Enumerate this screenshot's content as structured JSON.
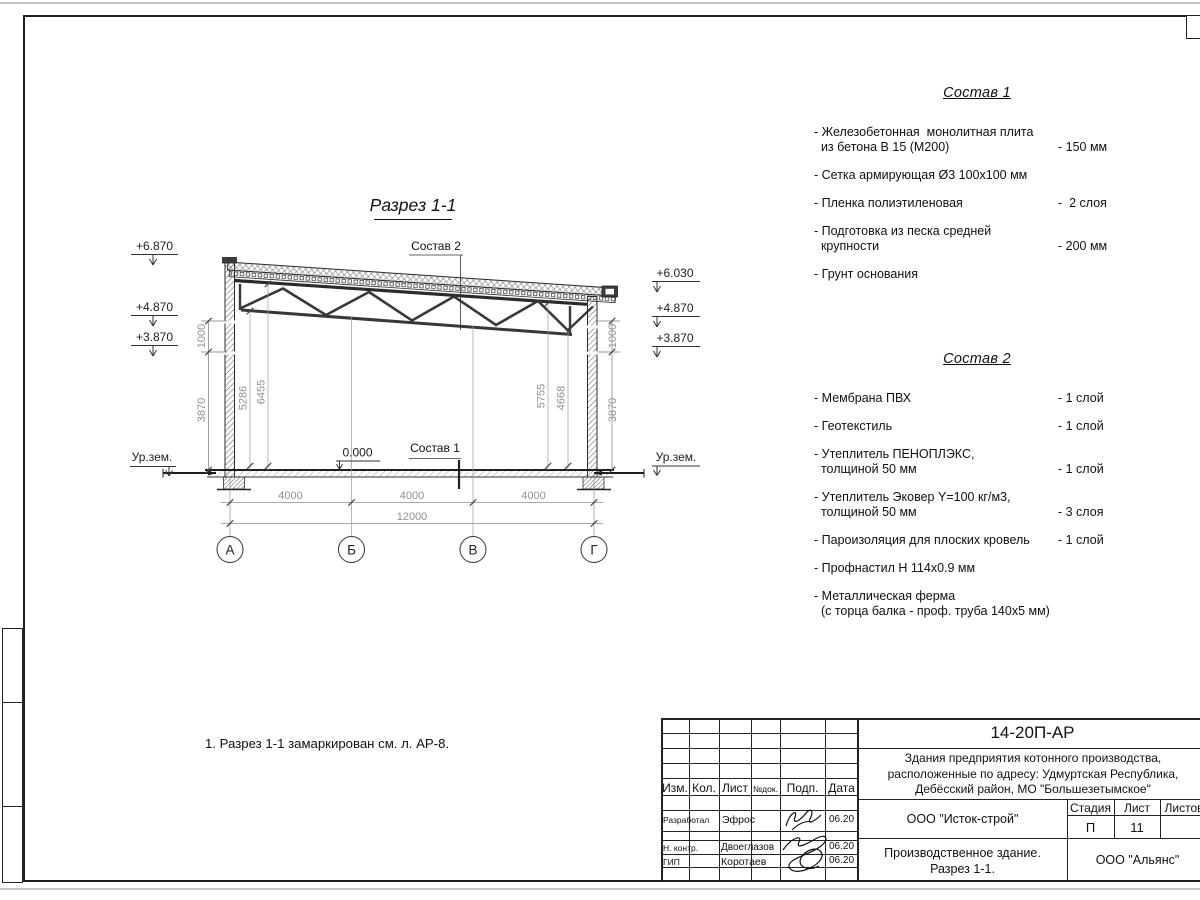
{
  "drawing": {
    "title": "Разрез 1-1",
    "sostav2_ref": "Состав 2",
    "sostav1_ref": "Состав 1",
    "zero_mark": "0.000",
    "ground_level_left": "Ур.зем.",
    "ground_level_right": "Ур.зем.",
    "elevations_left": [
      "+6.870",
      "+4.870",
      "+3.870"
    ],
    "elevations_right": [
      "+6.030",
      "+4.870",
      "+3.870"
    ],
    "vertical_dims_left": [
      "1000",
      "3870"
    ],
    "vertical_dims_right": [
      "1000",
      "3870"
    ],
    "interior_dims": [
      "5286",
      "6455",
      "5755",
      "4668"
    ],
    "span_dims": [
      "4000",
      "4000",
      "4000"
    ],
    "total_dim": "12000",
    "axes": [
      "А",
      "Б",
      "В",
      "Г"
    ]
  },
  "note": "1. Разрез 1-1 замаркирован см. л. АР-8.",
  "sostav1": {
    "title": "Состав 1",
    "items": [
      {
        "label": "- Железобетонная  монолитная плита\n  из бетона В 15 (М200)",
        "value": "- 150 мм"
      },
      {
        "label": "- Сетка армирующая Ø3 100x100 мм",
        "value": ""
      },
      {
        "label": "- Пленка полиэтиленовая",
        "value": "-  2 слоя"
      },
      {
        "label": "- Подготовка из песка средней\n  крупности",
        "value": "- 200 мм"
      },
      {
        "label": "- Грунт основания",
        "value": ""
      }
    ]
  },
  "sostav2": {
    "title": "Состав 2",
    "items": [
      {
        "label": "- Мембрана ПВХ",
        "value": "- 1 слой"
      },
      {
        "label": "- Геотекстиль",
        "value": "- 1 слой"
      },
      {
        "label": "- Утеплитель ПЕНОПЛЭКС,\n  толщиной 50 мм",
        "value": "- 1 слой"
      },
      {
        "label": "- Утеплитель Эковер Y=100 кг/м3,\n  толщиной 50 мм",
        "value": "- 3 слоя"
      },
      {
        "label": "- Пароизоляция для плоских кровель",
        "value": "- 1 слой"
      },
      {
        "label": "- Профнастил Н 114x0.9 мм",
        "value": ""
      },
      {
        "label": "- Металлическая ферма\n  (с торца балка - проф. труба 140x5 мм)",
        "value": ""
      }
    ]
  },
  "titleblock": {
    "doc_number": "14-20П-АР",
    "project_lines": [
      "Здания предприятия котонного производства,",
      "расположенные по адресу: Удмуртская Республика,",
      "Дебёсский район, МО \"Большезетымское\""
    ],
    "columns": [
      "Изм.",
      "Кол.",
      "Лист",
      "№док.",
      "Подп.",
      "Дата"
    ],
    "staff": [
      {
        "role": "Разработал",
        "name": "Эфрос",
        "date": "06.20"
      },
      {
        "role": "Н. контр.",
        "name": "Двоеглазов",
        "date": "06.20"
      },
      {
        "role": "ГИП",
        "name": "Коротаев",
        "date": "06.20"
      }
    ],
    "contractor": "ООО \"Исток-строй\"",
    "stage_label": "Стадия",
    "sheet_label": "Лист",
    "sheets_label": "Листов",
    "stage": "П",
    "sheet": "11",
    "object_lines": [
      "Производственное здание.",
      "Разрез 1-1."
    ],
    "organization": "ООО \"Альянс\""
  }
}
